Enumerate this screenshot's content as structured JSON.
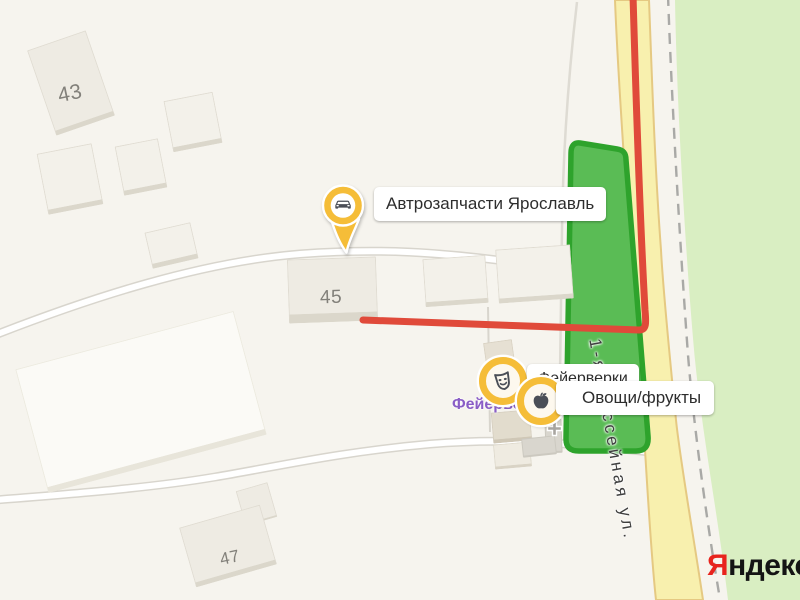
{
  "map": {
    "street": {
      "name": "1-я Шоссейная ул."
    },
    "buildings": [
      {
        "number": "43"
      },
      {
        "number": "45"
      },
      {
        "number": "47"
      }
    ],
    "pois": [
      {
        "label": "Автрозапчасти Ярославль",
        "icon": "car-pin-icon",
        "marker_style": "yellow-teardrop-pin"
      },
      {
        "label": "Фейерверки",
        "icon": "theater-mask-icon",
        "marker_style": "yellow-ring-badge"
      },
      {
        "label": "Овощи/фрукты",
        "icon": "apple-icon",
        "marker_style": "yellow-ring-badge"
      },
      {
        "label": "Фейерверки",
        "icon": "none",
        "marker_style": "purple-shop-name"
      }
    ],
    "logo": {
      "ya": "Я",
      "rest": "ндекс"
    },
    "colors": {
      "background": "#f6f4ee",
      "forest_green": "#d9eec2",
      "area_green_fill": "#5abc55",
      "area_green_border": "#2ea32c",
      "road_yellow_fill": "#f8f0ae",
      "road_yellow_border": "#e5c982",
      "traffic_red": "#e04a3a",
      "marker_yellow": "#f5bd38",
      "glyph_dark": "#4a4e57",
      "logo_red": "#e8231d"
    }
  }
}
